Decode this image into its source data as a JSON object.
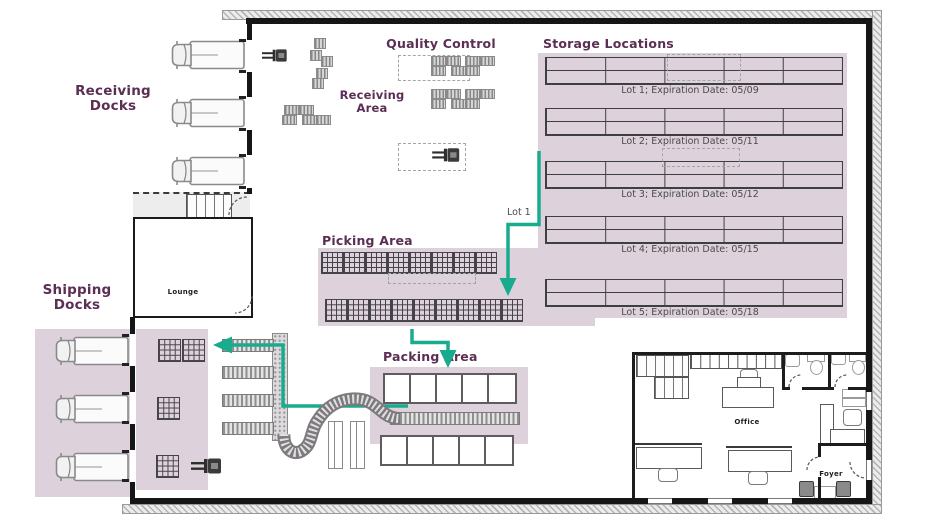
{
  "diagram_type": "warehouse-floor-plan",
  "colors": {
    "area_fill": "#ddd2dc",
    "title_text": "#5b2e53",
    "flow_arrow": "#18ab8e",
    "walls": "#161616"
  },
  "areas": {
    "receiving_docks": {
      "label": "Receiving\nDocks"
    },
    "shipping_docks": {
      "label": "Shipping\nDocks"
    },
    "quality_control": {
      "label": "Quality Control"
    },
    "receiving_area": {
      "label": "Receiving\nArea"
    },
    "picking_area": {
      "label": "Picking Area"
    },
    "packing_area": {
      "label": "Packing Area"
    }
  },
  "storage": {
    "title": "Storage Locations",
    "lots": [
      "Lot 1; Expiration Date: 05/09",
      "Lot 2; Expiration Date: 05/11",
      "Lot 3; Expiration Date: 05/12",
      "Lot 4; Expiration Date: 05/15",
      "Lot 5; Expiration Date: 05/18"
    ]
  },
  "rooms": {
    "lounge": {
      "label": "Lounge"
    },
    "office": {
      "label": "Office"
    },
    "foyer": {
      "label": "Foyer"
    }
  },
  "flow": {
    "lot1_arrow_label": "Lot 1"
  },
  "icons": {
    "truck_count": 6,
    "forklift_count": 3,
    "truck": "truck-icon",
    "forklift": "forklift-icon",
    "pallet": "pallet-icon"
  }
}
